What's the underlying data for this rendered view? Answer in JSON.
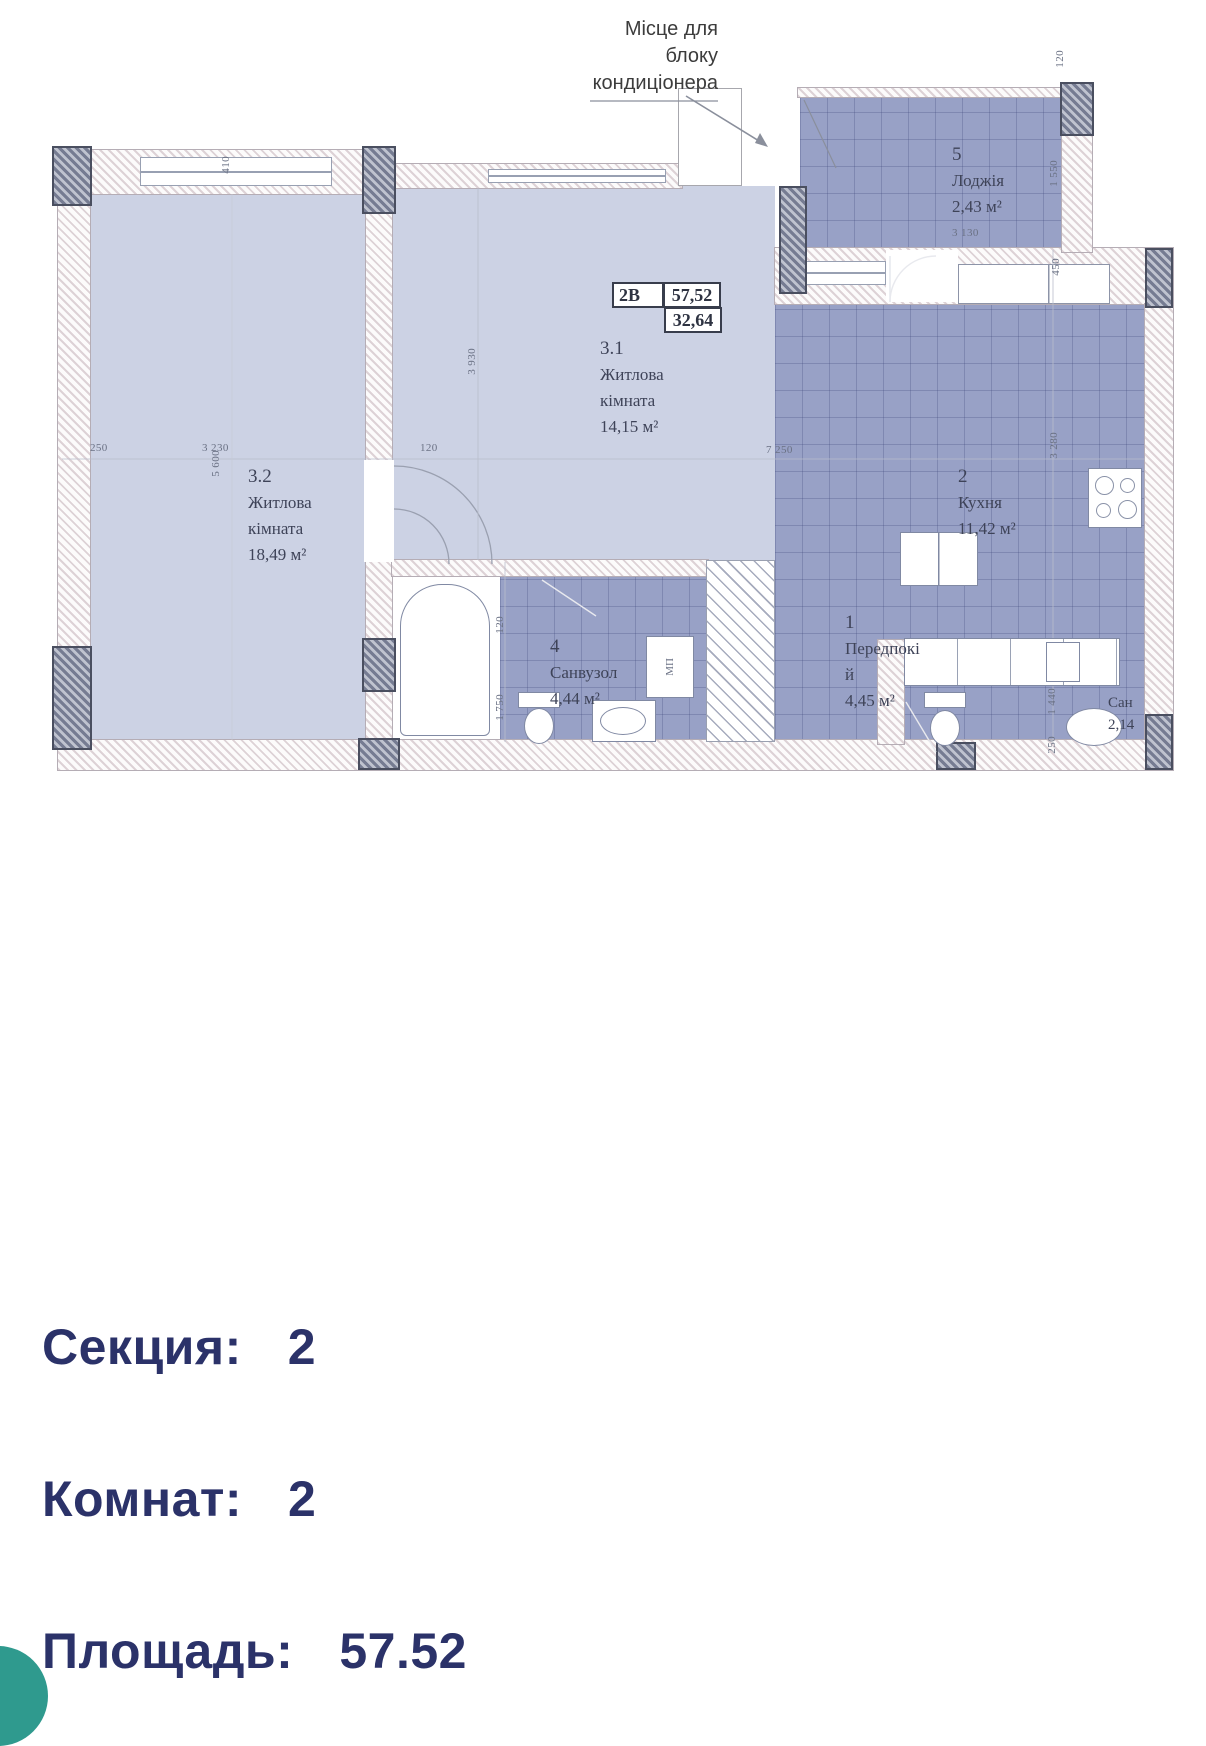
{
  "colors": {
    "accent_navy": "#2b3269",
    "room_light": "#ccd2e4",
    "room_dark": "#98a1c6",
    "fab_teal": "#2f9a8e"
  },
  "plan": {
    "ac_note": "Місце для блоку кондиціонера",
    "unit_box": {
      "code": "2В",
      "area_total": "57,52",
      "area_living": "32,64"
    },
    "labels": {
      "mp": "МП"
    },
    "rooms": {
      "loggia": {
        "num": "5",
        "name": "Лоджія",
        "area": "2,43 м²",
        "width_dim": "3 130"
      },
      "living1": {
        "num": "3.1",
        "name": "Житлова кімната",
        "area": "14,15 м²"
      },
      "living2": {
        "num": "3.2",
        "name": "Житлова кімната",
        "area": "18,49 м²"
      },
      "kitchen": {
        "num": "2",
        "name": "Кухня",
        "area": "11,42 м²"
      },
      "hall": {
        "num": "1",
        "name": "Передпокій",
        "area": "4,45 м²"
      },
      "bathroom": {
        "num": "4",
        "name": "Санвузол",
        "area": "4,44 м²"
      },
      "wc": {
        "name": "Сан",
        "area": "2,14"
      }
    },
    "dims": {
      "t410": "410",
      "tr120": "120",
      "lg1550": "1 550",
      "lg450": "450",
      "k3280": "3 280",
      "r1440": "1 440",
      "r250": "250",
      "l250": "250",
      "l3230": "3 230",
      "m120": "120",
      "r7250": "7 250",
      "l5600": "5 600",
      "m3930": "3 930",
      "b120": "120",
      "b1750": "1 750"
    }
  },
  "info": {
    "section_label": "Секция:",
    "section_value": "2",
    "rooms_label": "Комнат:",
    "rooms_value": "2",
    "area_label": "Площадь:",
    "area_value": "57.52"
  }
}
